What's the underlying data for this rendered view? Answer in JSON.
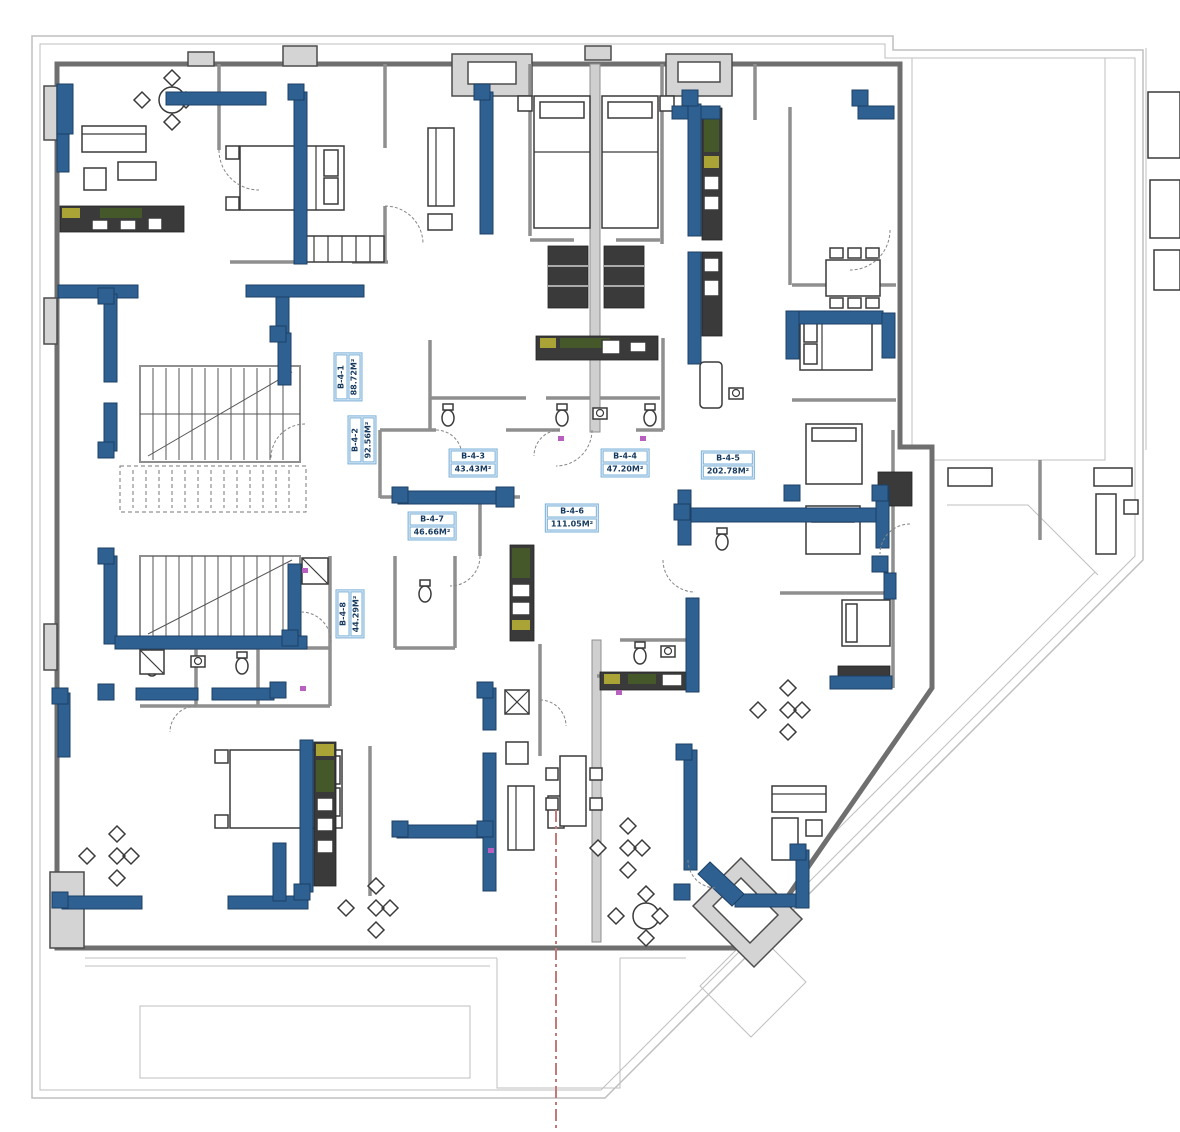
{
  "plan": {
    "units": [
      {
        "id": "B-4-1",
        "area": "88.72M²"
      },
      {
        "id": "B-4-2",
        "area": "92.56M²"
      },
      {
        "id": "B-4-3",
        "area": "43.43M²"
      },
      {
        "id": "B-4-4",
        "area": "47.20M²"
      },
      {
        "id": "B-4-5",
        "area": "202.78M²"
      },
      {
        "id": "B-4-6",
        "area": "111.05M²"
      },
      {
        "id": "B-4-7",
        "area": "46.66M²"
      },
      {
        "id": "B-4-8",
        "area": "44.29M²"
      }
    ]
  },
  "colors": {
    "structural_blue": "#2e6191",
    "structural_blue_dark": "#1c4066",
    "wall_gray": "#6f6f6f",
    "partition_gray": "#8f8f8f",
    "outline_light": "#bfbfbf",
    "furniture_dark": "#3a3a3a",
    "kitchen_green": "#44582a",
    "kitchen_yellow": "#aaa336",
    "accent_magenta": "#b95fc0",
    "section_red": "#c47878",
    "label_border": "#7ab0d8",
    "label_text": "#163a5f"
  }
}
